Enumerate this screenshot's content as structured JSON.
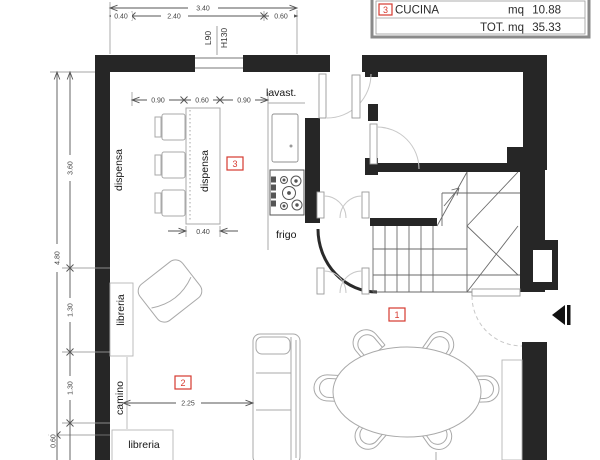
{
  "summary_table": {
    "room_number": "3",
    "room_name": "CUCINA",
    "unit_label": "mq",
    "area_value": "10.88",
    "total_label": "TOT. mq",
    "total_value": "35.33"
  },
  "dims": {
    "top_overall": "3.40",
    "top_seg1": "0.40",
    "top_seg2": "2.40",
    "top_seg3": "0.60",
    "left_overall": "4.80",
    "left_seg1": "3.60",
    "left_seg2": "1.30",
    "left_seg3": "1.30",
    "left_seg4": "0.60",
    "kitchen_seg1": "0.90",
    "kitchen_seg2": "0.60",
    "kitchen_seg3": "0.90",
    "island_width": "0.40",
    "living_span": "2.25"
  },
  "window_tag": {
    "width": "L90",
    "height": "H130"
  },
  "labels": {
    "wall_pantry": "dispensa",
    "island_pantry": "dispensa",
    "dishwasher": "lavast.",
    "fridge": "frigo",
    "bookcase_left": "libreria",
    "fireplace": "camino",
    "bookcase_bottom": "libreria"
  },
  "room_tags": {
    "living": "1",
    "fireplace_zone": "2",
    "kitchen": "3"
  },
  "colors": {
    "wall": "#262626",
    "furniture": "#a9a9a9",
    "dimension": "#555555",
    "accent_red": "#d63a30"
  }
}
